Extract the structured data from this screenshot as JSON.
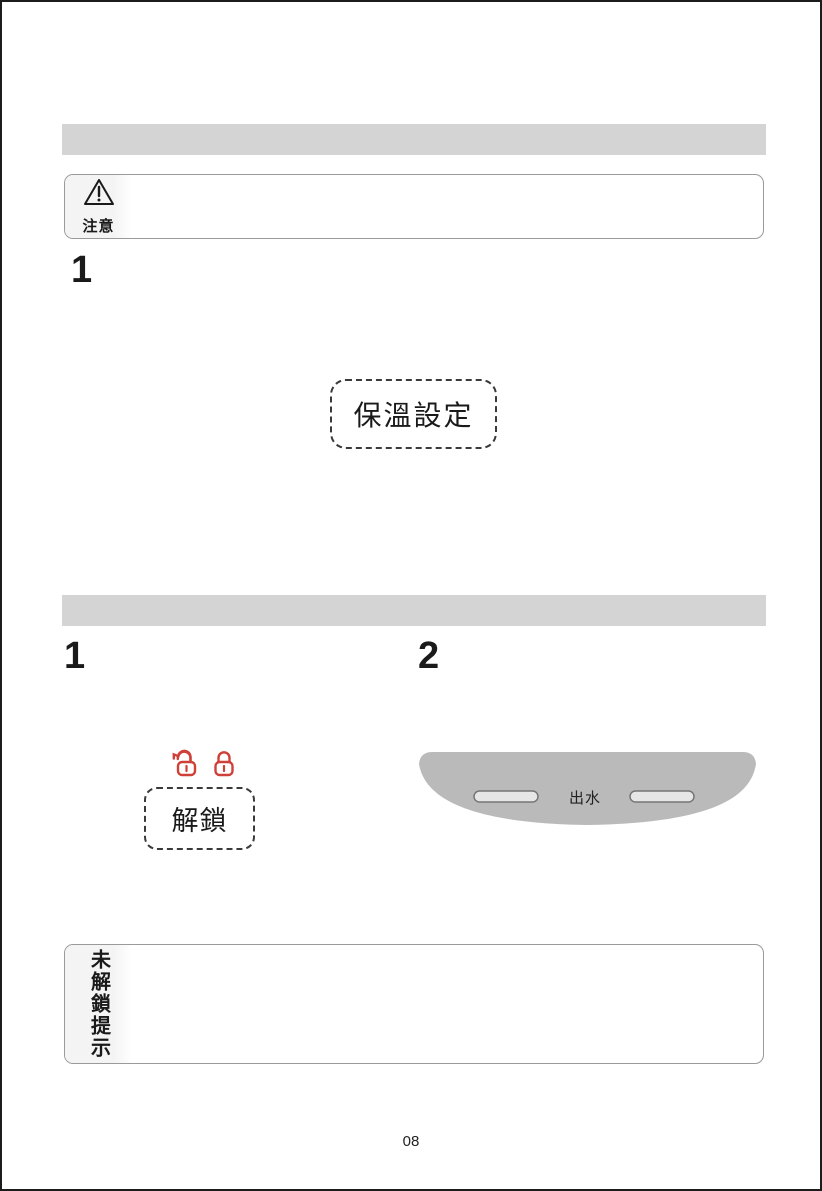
{
  "section_keep_warm": {
    "caution": {
      "icon": "warning-triangle-icon",
      "label": "注意"
    },
    "step": {
      "number": "1",
      "button_label": "保溫設定"
    }
  },
  "section_unlock_dispense": {
    "step1": {
      "number": "1",
      "lock_icons": [
        "unlocked-padlock-icon",
        "locked-padlock-icon"
      ],
      "button_label": "解鎖"
    },
    "step2": {
      "number": "2",
      "panel_label": "出水"
    }
  },
  "note_box": {
    "side_label": "未解鎖提示"
  },
  "footer": {
    "page_number": "08"
  },
  "colors": {
    "lock_red": "#cf4038",
    "header_bar_gray": "#d4d4d4",
    "device_panel_gray": "#bababa",
    "box_border_gray": "#9a9a9a"
  }
}
